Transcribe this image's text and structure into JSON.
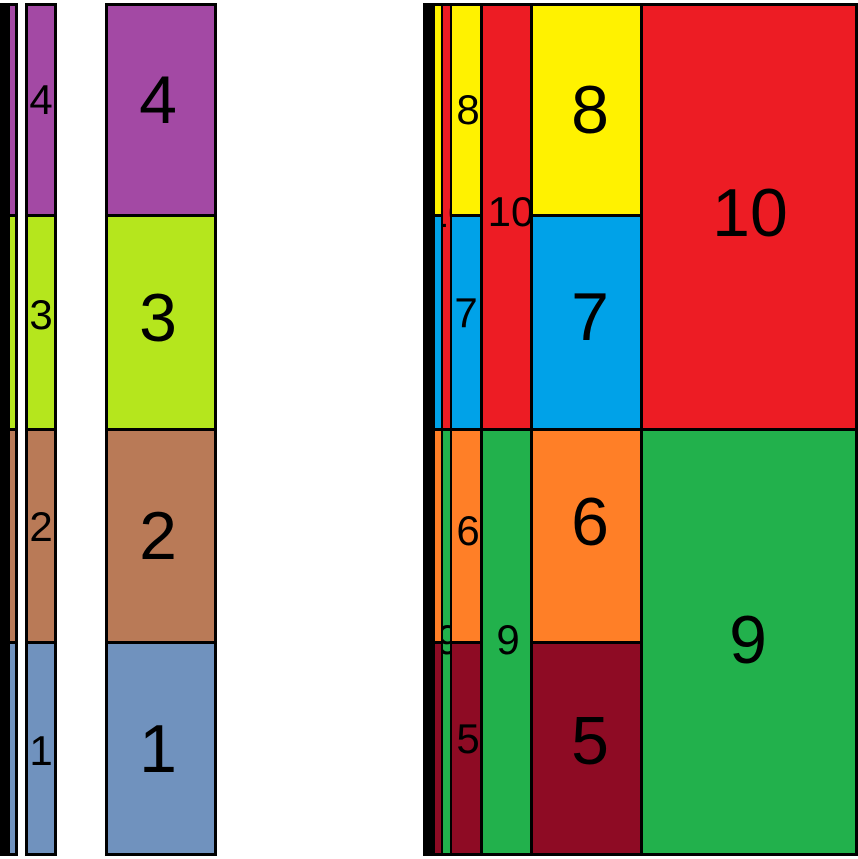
{
  "meta": {
    "description": "Figure showing a stacked bar (items 1-4) and a treemap (items 5-10), each rendered at four increasing widths",
    "canvas_width_px": 858,
    "canvas_height_px": 859,
    "background": "#FFFFFF"
  },
  "chart_data": [
    {
      "type": "treemap",
      "subtype": "stacked-bar-slice-layout",
      "title": "",
      "items": [
        {
          "label": "1",
          "relative_area": 1,
          "color": "#7092BE",
          "position": "bottom segment"
        },
        {
          "label": "2",
          "relative_area": 1,
          "color": "#B97A57",
          "position": "lower-middle segment"
        },
        {
          "label": "3",
          "relative_area": 1,
          "color": "#B5E61D",
          "position": "upper-middle segment"
        },
        {
          "label": "4",
          "relative_area": 1,
          "color": "#A349A4",
          "position": "top segment"
        }
      ],
      "rendered_bar_widths_px": [
        7,
        11,
        32,
        112
      ],
      "bar_height_px": 853,
      "legend": "none",
      "grid": "off",
      "layout_note": "same 4-segment stacked bar drawn 4 times side by side at increasing widths; equal quarter-height segments; black outlines; labels only visible on the two widest bars"
    },
    {
      "type": "treemap",
      "title": "",
      "items": [
        {
          "label": "5",
          "relative_area": 1,
          "color": "#8E0B24",
          "position": "left column, bottom quarter"
        },
        {
          "label": "6",
          "relative_area": 1,
          "color": "#FF7F27",
          "position": "left column, third quarter"
        },
        {
          "label": "7",
          "relative_area": 1,
          "color": "#00A2E8",
          "position": "left column, second quarter"
        },
        {
          "label": "8",
          "relative_area": 1,
          "color": "#FFF200",
          "position": "left column, top quarter"
        },
        {
          "label": "9",
          "relative_area": 2,
          "color": "#22B14C",
          "position": "right column, bottom half"
        },
        {
          "label": "10",
          "relative_area": 2,
          "color": "#ED1C24",
          "position": "right column, top half"
        }
      ],
      "rendered_widths_px": [
        12,
        20,
        101,
        430
      ],
      "height_px": 853,
      "legend": "none",
      "grid": "off",
      "layout_note": "same treemap drawn 4 times, left-aligned and overlapping with the narrowest copy on top; black outlines; labels visible on the two widest copies, clipped label fragments on the thin copy"
    }
  ],
  "figure": {
    "palette": {
      "outline": "#000000",
      "blue1": "#7092BE",
      "brown2": "#B97A57",
      "lime3": "#B5E61D",
      "purple4": "#A349A4",
      "maroon5": "#8E0B24",
      "orange6": "#FF7F27",
      "cyan7": "#00A2E8",
      "yellow8": "#FFF200",
      "green9": "#22B14C",
      "red10": "#ED1C24"
    },
    "charts": [
      {
        "name": "stacked-bar-width-1",
        "x": 0,
        "y": 3,
        "w": 7,
        "h": 853,
        "boxes": []
      },
      {
        "name": "stacked-bar-width-2",
        "x": 7,
        "y": 3,
        "w": 11,
        "h": 853,
        "boxes": [
          {
            "id": "4",
            "x": 3,
            "y": 3,
            "w": 5,
            "h": 208,
            "color": "purple4"
          },
          {
            "id": "3",
            "x": 3,
            "y": 214,
            "w": 5,
            "h": 211,
            "color": "lime3"
          },
          {
            "id": "2",
            "x": 3,
            "y": 428,
            "w": 5,
            "h": 210,
            "color": "brown2"
          },
          {
            "id": "1",
            "x": 3,
            "y": 641,
            "w": 5,
            "h": 209,
            "color": "blue1"
          }
        ]
      },
      {
        "name": "stacked-bar-width-3",
        "x": 25,
        "y": 3,
        "w": 32,
        "h": 853,
        "boxes": [
          {
            "id": "4",
            "x": 3,
            "y": 3,
            "w": 26,
            "h": 208,
            "color": "purple4",
            "label": {
              "text": "4",
              "dx": 13,
              "dy": 94,
              "size": "small"
            }
          },
          {
            "id": "3",
            "x": 3,
            "y": 214,
            "w": 26,
            "h": 211,
            "color": "lime3",
            "label": {
              "text": "3",
              "dx": 13,
              "dy": 98,
              "size": "small"
            }
          },
          {
            "id": "2",
            "x": 3,
            "y": 428,
            "w": 26,
            "h": 210,
            "color": "brown2",
            "label": {
              "text": "2",
              "dx": 13,
              "dy": 96,
              "size": "small"
            }
          },
          {
            "id": "1",
            "x": 3,
            "y": 641,
            "w": 26,
            "h": 209,
            "color": "blue1",
            "label": {
              "text": "1",
              "dx": 13,
              "dy": 107,
              "size": "small"
            }
          }
        ]
      },
      {
        "name": "stacked-bar-width-4",
        "x": 105,
        "y": 3,
        "w": 112,
        "h": 853,
        "boxes": [
          {
            "id": "4",
            "x": 3,
            "y": 3,
            "w": 106,
            "h": 208,
            "color": "purple4",
            "label": {
              "text": "4",
              "dx": 50,
              "dy": 94,
              "size": "big"
            }
          },
          {
            "id": "3",
            "x": 3,
            "y": 214,
            "w": 106,
            "h": 211,
            "color": "lime3",
            "label": {
              "text": "3",
              "dx": 50,
              "dy": 101,
              "size": "big"
            }
          },
          {
            "id": "2",
            "x": 3,
            "y": 428,
            "w": 106,
            "h": 210,
            "color": "brown2",
            "label": {
              "text": "2",
              "dx": 50,
              "dy": 105,
              "size": "big"
            }
          },
          {
            "id": "1",
            "x": 3,
            "y": 641,
            "w": 106,
            "h": 209,
            "color": "blue1",
            "label": {
              "text": "1",
              "dx": 50,
              "dy": 105,
              "size": "big"
            }
          }
        ]
      },
      {
        "name": "treemap-width-4",
        "x": 428,
        "y": 3,
        "w": 430,
        "h": 853,
        "boxes": [
          {
            "id": "8",
            "x": 3,
            "y": 3,
            "w": 209,
            "h": 208,
            "color": "yellow8",
            "label": {
              "text": "8",
              "dx": 159,
              "dy": 104,
              "size": "big"
            }
          },
          {
            "id": "7",
            "x": 3,
            "y": 214,
            "w": 209,
            "h": 211,
            "color": "cyan7",
            "label": {
              "text": "7",
              "dx": 159,
              "dy": 100,
              "size": "big"
            }
          },
          {
            "id": "10",
            "x": 215,
            "y": 3,
            "w": 212,
            "h": 422,
            "color": "red10",
            "label": {
              "text": "10",
              "dx": 107,
              "dy": 207,
              "size": "big"
            }
          },
          {
            "id": "6",
            "x": 3,
            "y": 428,
            "w": 209,
            "h": 210,
            "color": "orange6",
            "label": {
              "text": "6",
              "dx": 159,
              "dy": 91,
              "size": "big"
            }
          },
          {
            "id": "5",
            "x": 3,
            "y": 641,
            "w": 209,
            "h": 209,
            "color": "maroon5",
            "label": {
              "text": "5",
              "dx": 159,
              "dy": 97,
              "size": "big"
            }
          },
          {
            "id": "9",
            "x": 215,
            "y": 428,
            "w": 212,
            "h": 422,
            "color": "green9",
            "label": {
              "text": "9",
              "dx": 105,
              "dy": 209,
              "size": "big"
            }
          }
        ]
      },
      {
        "name": "treemap-width-3",
        "x": 432,
        "y": 3,
        "w": 101,
        "h": 853,
        "boxes": [
          {
            "id": "8",
            "x": 3,
            "y": 3,
            "w": 45,
            "h": 208,
            "color": "yellow8",
            "label": {
              "text": "8",
              "dx": 33,
              "dy": 104,
              "size": "small"
            }
          },
          {
            "id": "7",
            "x": 3,
            "y": 214,
            "w": 45,
            "h": 211,
            "color": "cyan7",
            "label": {
              "text": "7",
              "dx": 31,
              "dy": 96,
              "size": "small"
            }
          },
          {
            "id": "10",
            "x": 51,
            "y": 3,
            "w": 47,
            "h": 422,
            "color": "red10",
            "label": {
              "text": "10",
              "dx": 28,
              "dy": 206,
              "size": "small"
            }
          },
          {
            "id": "6",
            "x": 3,
            "y": 428,
            "w": 45,
            "h": 210,
            "color": "orange6",
            "label": {
              "text": "6",
              "dx": 33,
              "dy": 100,
              "size": "small"
            }
          },
          {
            "id": "5",
            "x": 3,
            "y": 641,
            "w": 45,
            "h": 209,
            "color": "maroon5",
            "label": {
              "text": "5",
              "dx": 33,
              "dy": 95,
              "size": "small"
            }
          },
          {
            "id": "9",
            "x": 51,
            "y": 428,
            "w": 47,
            "h": 422,
            "color": "green9",
            "label": {
              "text": "9",
              "dx": 25,
              "dy": 209,
              "size": "small"
            }
          }
        ]
      },
      {
        "name": "treemap-width-2",
        "x": 432,
        "y": 3,
        "w": 20,
        "h": 853,
        "boxes": [
          {
            "id": "8",
            "x": 3,
            "y": 3,
            "w": 6,
            "h": 208,
            "color": "yellow8"
          },
          {
            "id": "7",
            "x": 3,
            "y": 214,
            "w": 6,
            "h": 211,
            "color": "cyan7"
          },
          {
            "id": "10",
            "x": 11,
            "y": 3,
            "w": 7,
            "h": 422,
            "color": "red10",
            "label": {
              "text": "10",
              "dx": 5,
              "dy": 207,
              "size": "small"
            }
          },
          {
            "id": "6",
            "x": 3,
            "y": 428,
            "w": 6,
            "h": 210,
            "color": "orange6"
          },
          {
            "id": "5",
            "x": 3,
            "y": 641,
            "w": 6,
            "h": 209,
            "color": "maroon5"
          },
          {
            "id": "9",
            "x": 11,
            "y": 428,
            "w": 7,
            "h": 422,
            "color": "green9",
            "label": {
              "text": "9",
              "dx": 5,
              "dy": 209,
              "size": "small"
            }
          }
        ]
      },
      {
        "name": "treemap-width-1",
        "x": 423,
        "y": 3,
        "w": 12,
        "h": 853,
        "boxes": []
      }
    ]
  }
}
